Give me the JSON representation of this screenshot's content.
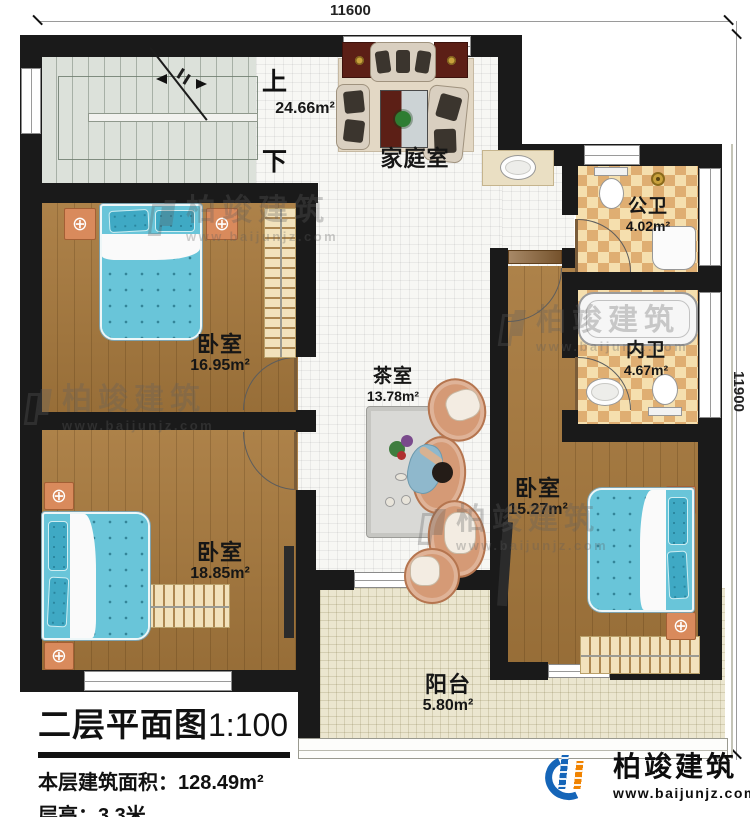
{
  "dimensions": {
    "top": "11600",
    "right": "11900"
  },
  "stairs": {
    "up": "上",
    "down": "下"
  },
  "rooms": {
    "family": {
      "name": "家庭室",
      "area": "24.66m²"
    },
    "public_bath": {
      "name": "公卫",
      "area": "4.02m²"
    },
    "private_bath": {
      "name": "内卫",
      "area": "4.67m²"
    },
    "bedroom1": {
      "name": "卧室",
      "area": "16.95m²"
    },
    "tea": {
      "name": "茶室",
      "area": "13.78m²"
    },
    "bedroom2": {
      "name": "卧室",
      "area": "18.85m²"
    },
    "bedroom3": {
      "name": "卧室",
      "area": "15.27m²"
    },
    "balcony": {
      "name": "阳台",
      "area": "5.80m²"
    }
  },
  "title_block": {
    "title": "二层平面图",
    "scale": "1:100",
    "floor_area_label": "本层建筑面积：",
    "floor_area_value": "128.49m²",
    "floor_height_label": "层高：",
    "floor_height_value": "3.3米"
  },
  "logo": {
    "name": "柏竣建筑",
    "url": "www.baijunjz.com"
  },
  "watermark": {
    "name": "柏竣建筑",
    "url": "www.baijunjz.com"
  },
  "colors": {
    "wall": "#1a1a1a",
    "wood": "#a87a3e",
    "tile": "#f7f7f4",
    "bath_light": "#f5dfae",
    "bath_dark": "#dfae72",
    "balcony": "#ebe6cf",
    "stair": "#dce1da",
    "bed": "#69c5d9",
    "brand_blue": "#1565b8",
    "brand_orange": "#f08300"
  }
}
